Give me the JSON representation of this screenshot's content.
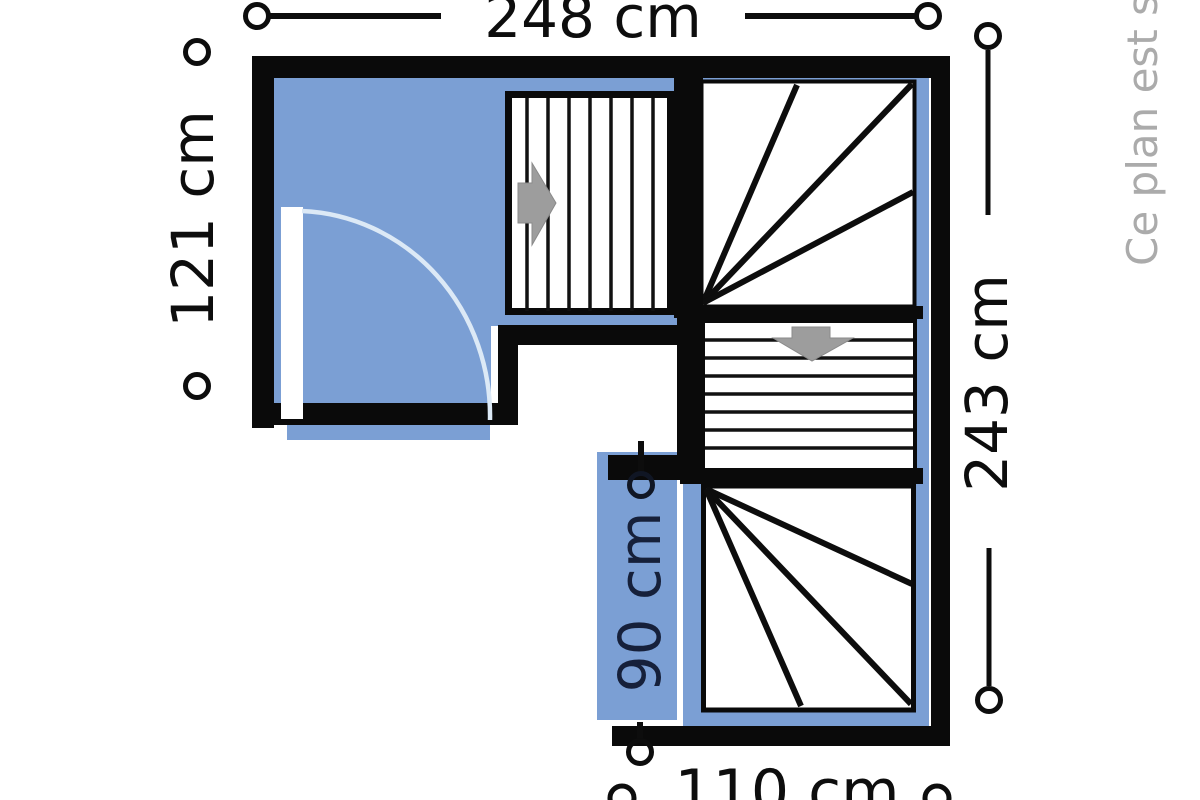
{
  "plan": {
    "watermark": "Ce plan est s",
    "dimensions": {
      "top": "248 cm",
      "left": "121 cm",
      "right": "243 cm",
      "stair_width": "90 cm",
      "bottom": "110 cm"
    },
    "colors": {
      "room_blue": "#7b9fd4",
      "wall": "#0a0a0a",
      "arrow_gray": "#9d9d9d",
      "door_arc": "#dce9f6",
      "watermark_gray": "#ababab",
      "stair_width_text": "#16203a"
    }
  }
}
